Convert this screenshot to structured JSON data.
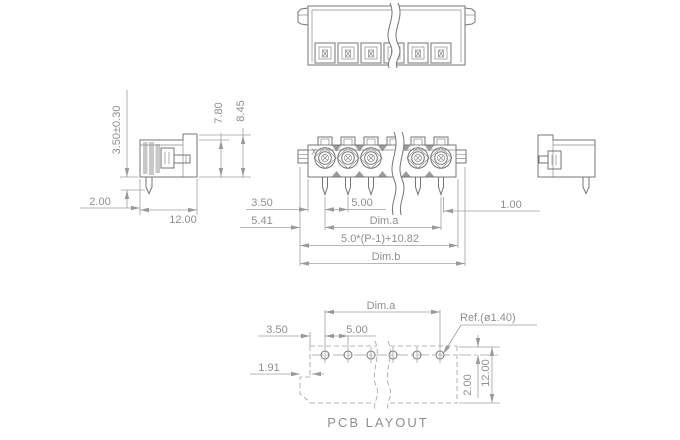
{
  "colors": {
    "outline": "#757575",
    "dimension": "#a0a0a0",
    "text": "#8f8f8f",
    "background": "#ffffff"
  },
  "side_view": {
    "pin_length_tol": "3.50±0.30",
    "front_height": "7.80",
    "total_height": "8.45",
    "pin_tip": "2.00",
    "depth": "12.00"
  },
  "front_view": {
    "edge_to_pin": "3.50",
    "pitch": "5.00",
    "offset": "5.41",
    "span_label": "Dim.a",
    "length_formula": "5.0*(P-1)+10.82",
    "overall_label": "Dim.b",
    "pin_width": "1.00",
    "polarity_mark": "X"
  },
  "pcb_layout": {
    "span_label": "Dim.a",
    "hole_ref": "Ref.(ø1.40)",
    "edge_to_hole": "3.50",
    "pitch": "5.00",
    "notch_offset": "1.91",
    "row_offset": "2.00",
    "depth": "12.00",
    "title": "PCB LAYOUT"
  }
}
